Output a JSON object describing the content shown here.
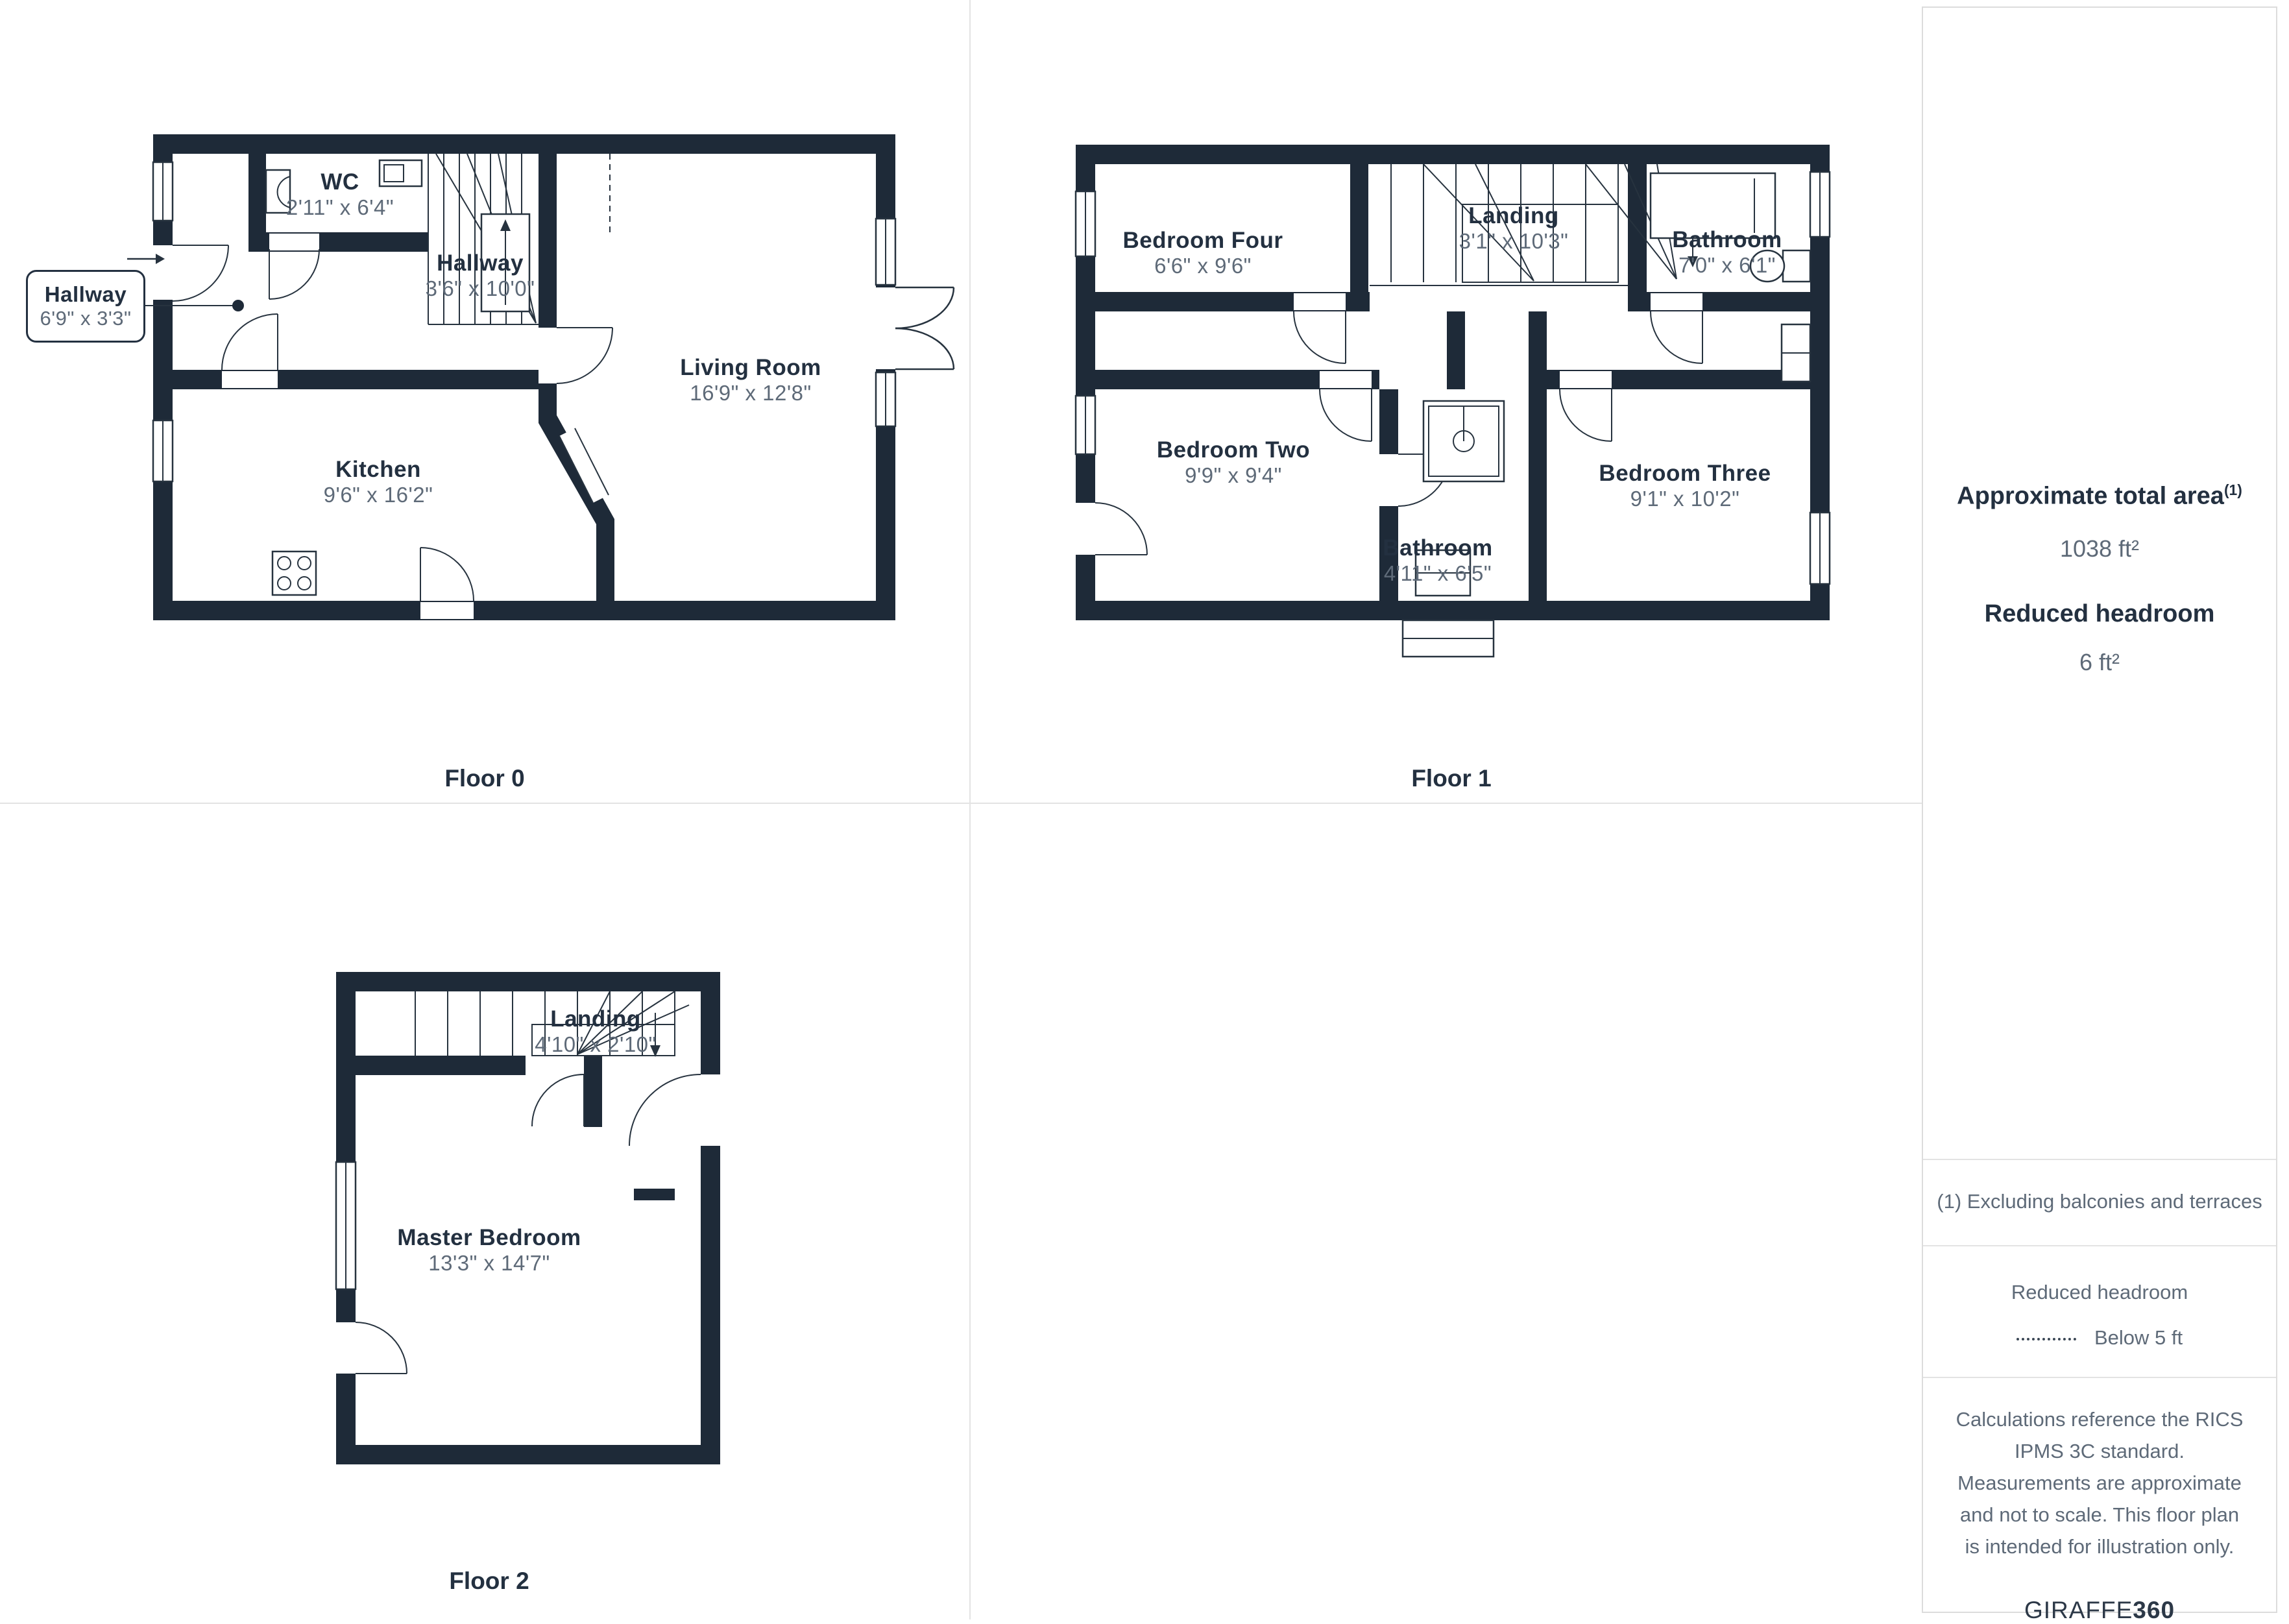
{
  "floors": [
    {
      "label": "Floor 0",
      "rooms": [
        {
          "name": "WC",
          "dims": "2'11\" x 6'4\""
        },
        {
          "name": "Hallway",
          "dims": "3'6\" x 10'0\""
        },
        {
          "name": "Living Room",
          "dims": "16'9\" x 12'8\""
        },
        {
          "name": "Kitchen",
          "dims": "9'6\" x 16'2\""
        }
      ],
      "callout": {
        "name": "Hallway",
        "dims": "6'9\" x 3'3\""
      }
    },
    {
      "label": "Floor 1",
      "rooms": [
        {
          "name": "Bedroom Four",
          "dims": "6'6\" x 9'6\""
        },
        {
          "name": "Landing",
          "dims": "3'1\" x 10'3\""
        },
        {
          "name": "Bathroom",
          "dims": "7'0\" x 6'1\""
        },
        {
          "name": "Bedroom Two",
          "dims": "9'9\" x 9'4\""
        },
        {
          "name": "Bathroom",
          "dims": "4'11\" x 6'5\""
        },
        {
          "name": "Bedroom Three",
          "dims": "9'1\" x 10'2\""
        }
      ]
    },
    {
      "label": "Floor 2",
      "rooms": [
        {
          "name": "Landing",
          "dims": "4'10\" x 2'10\""
        },
        {
          "name": "Master Bedroom",
          "dims": "13'3\" x 14'7\""
        }
      ]
    }
  ],
  "sidebar": {
    "total_area_label": "Approximate total area",
    "total_area_footnote_mark": "(1)",
    "total_area_value": "1038 ft²",
    "reduced_headroom_label": "Reduced headroom",
    "reduced_headroom_value": "6 ft²",
    "footnote": "(1) Excluding balconies and terraces",
    "legend_title": "Reduced headroom",
    "legend_item": "Below 5 ft",
    "disclaimer": "Calculations reference the RICS IPMS 3C standard. Measurements are approximate and not to scale. This floor plan is intended for illustration only.",
    "brand_prefix": "GIRAFFE",
    "brand_suffix": "360"
  },
  "colors": {
    "wall": "#1e2a38",
    "room_name": "#233040",
    "room_dims": "#5e6a78",
    "divider": "#e3e3e3"
  }
}
